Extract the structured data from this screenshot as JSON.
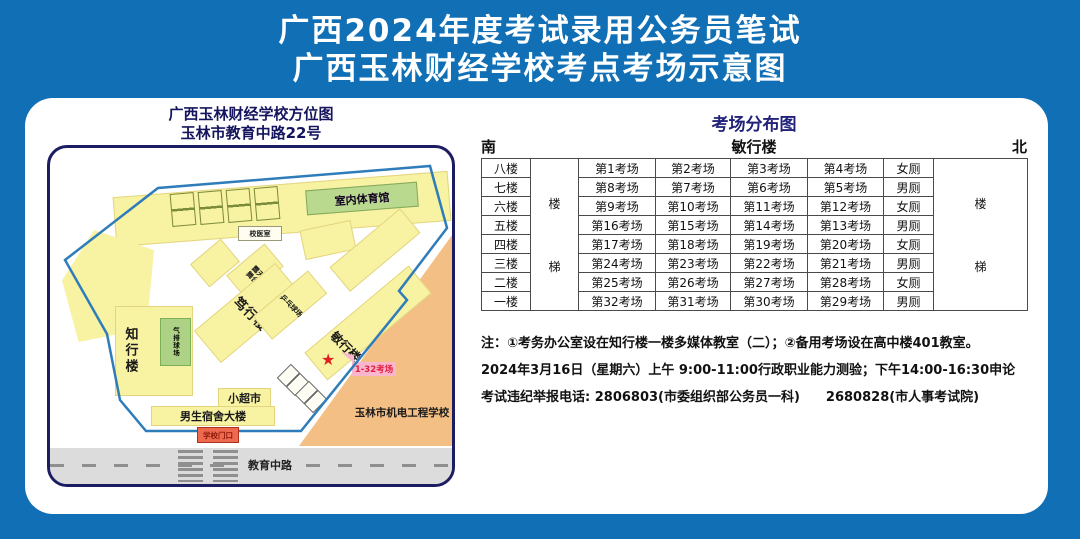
{
  "header": {
    "title_line1": "广西2024年度考试录用公务员笔试",
    "title_line2": "广西玉林财经学校考点考场示意图"
  },
  "map": {
    "title_line1": "广西玉林财经学校方位图",
    "title_line2": "玉林市教育中路22号",
    "gym": "室内体育馆",
    "clinic": "校医室",
    "zhixing_building": "知行楼",
    "volleyball_court": "气排球场",
    "stage_line1": "露天",
    "stage_line2": "舞台",
    "duxing_building": "笃行楼",
    "pingpong_court": "乒乓球场",
    "minxing_building": "敏行楼",
    "star": "★",
    "exam_rooms_tag": "1-32考场",
    "supermarket": "小超市",
    "dorm": "男生宿舍大楼",
    "gate": "学校门口",
    "road": "教育中路",
    "neighbor_school": "玉林市机电工程学校"
  },
  "distribution": {
    "title": "考场分布图",
    "south": "南",
    "building": "敏行楼",
    "north": "北",
    "stair_char1": "楼",
    "stair_char2": "梯",
    "rows": [
      {
        "floor": "八楼",
        "c1": "第1考场",
        "c2": "第2考场",
        "c3": "第3考场",
        "c4": "第4考场",
        "wc": "女厕"
      },
      {
        "floor": "七楼",
        "c1": "第8考场",
        "c2": "第7考场",
        "c3": "第6考场",
        "c4": "第5考场",
        "wc": "男厕"
      },
      {
        "floor": "六楼",
        "c1": "第9考场",
        "c2": "第10考场",
        "c3": "第11考场",
        "c4": "第12考场",
        "wc": "女厕"
      },
      {
        "floor": "五楼",
        "c1": "第16考场",
        "c2": "第15考场",
        "c3": "第14考场",
        "c4": "第13考场",
        "wc": "男厕"
      },
      {
        "floor": "四楼",
        "c1": "第17考场",
        "c2": "第18考场",
        "c3": "第19考场",
        "c4": "第20考场",
        "wc": "女厕"
      },
      {
        "floor": "三楼",
        "c1": "第24考场",
        "c2": "第23考场",
        "c3": "第22考场",
        "c4": "第21考场",
        "wc": "男厕"
      },
      {
        "floor": "二楼",
        "c1": "第25考场",
        "c2": "第26考场",
        "c3": "第27考场",
        "c4": "第28考场",
        "wc": "女厕"
      },
      {
        "floor": "一楼",
        "c1": "第32考场",
        "c2": "第31考场",
        "c3": "第30考场",
        "c4": "第29考场",
        "wc": "男厕"
      }
    ]
  },
  "notes": {
    "line1": "注：①考务办公室设在知行楼一楼多媒体教室（二）；②备用考场设在高中楼401教室。",
    "line2": "2024年3月16日（星期六）上午 9:00-11:00行政职业能力测验；下午14:00-16:30申论",
    "line3": "考试违纪举报电话: 2806803(市委组织部公务员一科)　　2680828(市人事考试院)"
  },
  "colors": {
    "background_blue": "#1170b5",
    "navy": "#1c1c62",
    "building_yellow": "#f8f2a3",
    "court_green": "#aed285",
    "gym_green": "#b9d98e",
    "neighbor_orange": "#f3bf85",
    "road_gray": "#dcdcdc",
    "boundary_blue": "#2e7cba",
    "star_red": "#e02020",
    "tag_pink": "#f9b6cd",
    "gate_red": "#ee6a4e"
  }
}
